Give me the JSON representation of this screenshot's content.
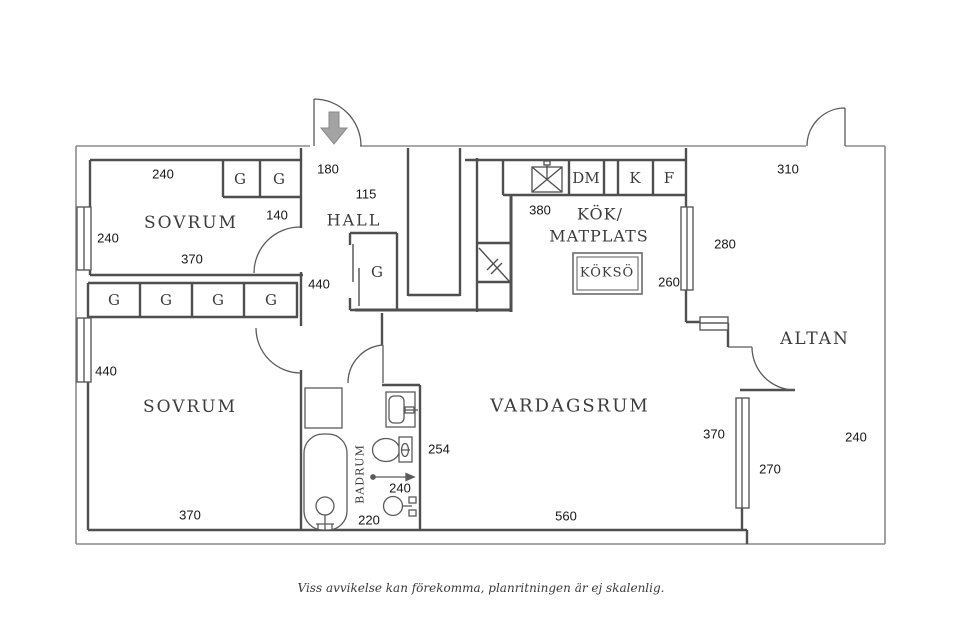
{
  "colors": {
    "outer_wall": "#8a8a8a",
    "inner_wall": "#4f4f4f",
    "fixture": "#5a5a5a",
    "entry_arrow": "#a3a3a3",
    "background": "#ffffff",
    "text": "#1c1c1c"
  },
  "footer": "Viss avvikelse kan förekomma, planritningen är ej skalenlig.",
  "rooms": {
    "sovrum_top": {
      "name": "SOVRUM",
      "dim_top": "240",
      "dim_left": "240",
      "dim_bottom": "370",
      "closet_dim": "140",
      "closets": [
        "G",
        "G"
      ]
    },
    "sovrum_bottom": {
      "name": "SOVRUM",
      "dim_left": "440",
      "dim_bottom": "370",
      "closets": [
        "G",
        "G",
        "G",
        "G"
      ]
    },
    "hall": {
      "name": "HALL",
      "dim_entry": "180",
      "dim_inner": "115",
      "dim_side": "440",
      "closet": "G"
    },
    "corridor": {
      "dim_length": "334"
    },
    "stairs": {
      "label": "U",
      "dim": "190"
    },
    "kitchen": {
      "name_line1": "KÖK/",
      "name_line2": "MATPLATS",
      "dim_left": "380",
      "dim_right": "260",
      "island_label": "KÖKSÖ",
      "appliances": [
        "DM",
        "K",
        "F"
      ]
    },
    "badrum": {
      "name": "BADRUM",
      "dim_width": "240",
      "dim_bottom": "220",
      "dim_wall": "254"
    },
    "vardagsrum": {
      "name": "VARDAGSRUM",
      "dim_bottom": "560",
      "dim_right": "370"
    },
    "altan": {
      "name": "ALTAN",
      "dim_top": "310",
      "dim_left": "280",
      "dim_window": "270",
      "dim_right": "240"
    }
  }
}
